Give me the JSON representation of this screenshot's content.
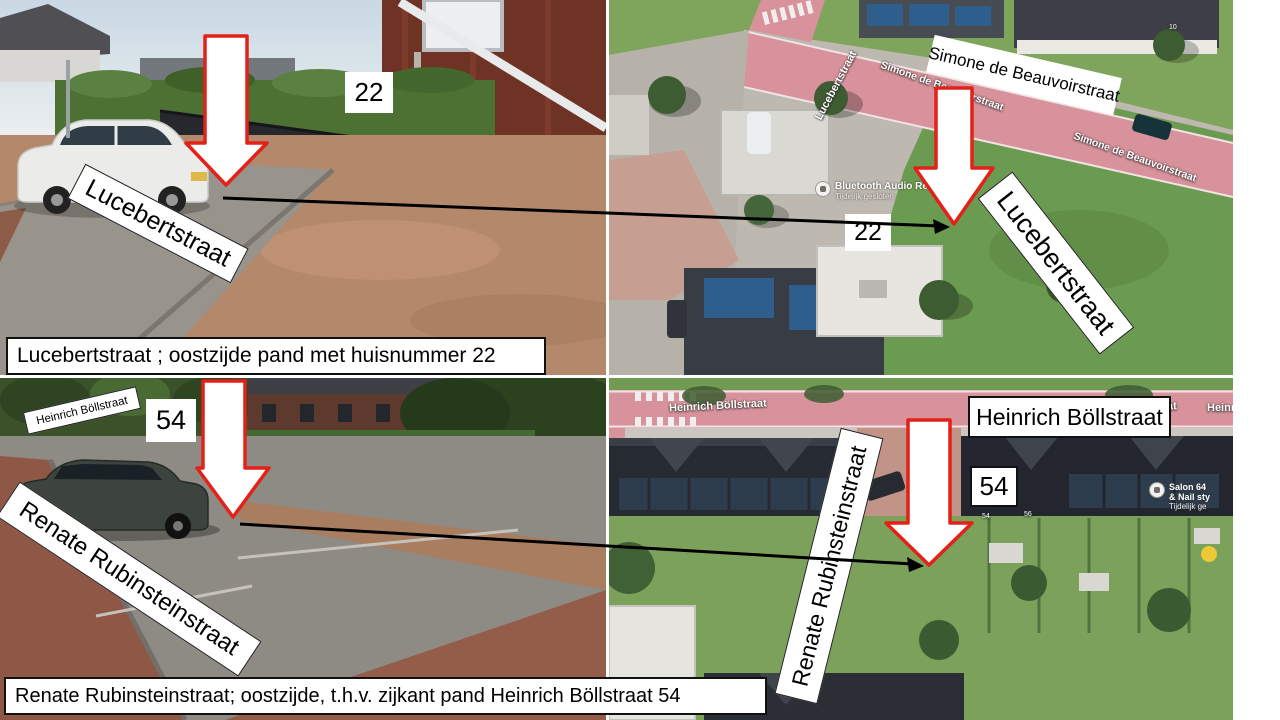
{
  "colors": {
    "arrow_fill": "#ffffff",
    "arrow_border": "#e32119",
    "connector_line": "#000000",
    "label_background": "#ffffff",
    "label_text": "#000000",
    "map_road_pink": "#d8929b",
    "map_grass_green": "#6b9b50"
  },
  "annotations": {
    "top_left": {
      "street_label": "Lucebertstraat",
      "house_number": "22",
      "caption": "Lucebertstraat ; oostzijde pand met huisnummer 22"
    },
    "top_right": {
      "boxed_street_label": "Simone de Beauvoirstraat",
      "house_number": "22",
      "rotated_street_label": "Lucebertstraat",
      "map": {
        "street_vertical": "Lucebertstraat",
        "street_diag_1": "Simone de Beauvoirstraat",
        "street_diag_2": "Simone de Beauvoirstraat",
        "poi_name": "Bluetooth Audio Re",
        "poi_status": "Tijdelijk gesloten",
        "roof_number": "10"
      }
    },
    "bottom_left": {
      "side_street_label": "Heinrich Böllstraat",
      "house_number": "54",
      "street_label": "Renate Rubinsteinstraat",
      "caption": "Renate Rubinsteinstraat; oostzijde, t.h.v. zijkant pand Heinrich Böllstraat 54"
    },
    "bottom_right": {
      "boxed_street_label": "Heinrich Böllstraat",
      "house_number": "54",
      "rotated_street_label": "Renate Rubinsteinstraat",
      "map": {
        "street_main": "Heinrich Böllstraat",
        "street_main_2": "Heinrich Böllstraat",
        "street_main_3": "Heinrich Böllstraat",
        "poi_line1": "Salon 64",
        "poi_line2": "& Nail sty",
        "poi_status": "Tijdelijk ge",
        "roof_numbers": [
          "54",
          "56"
        ]
      }
    }
  }
}
